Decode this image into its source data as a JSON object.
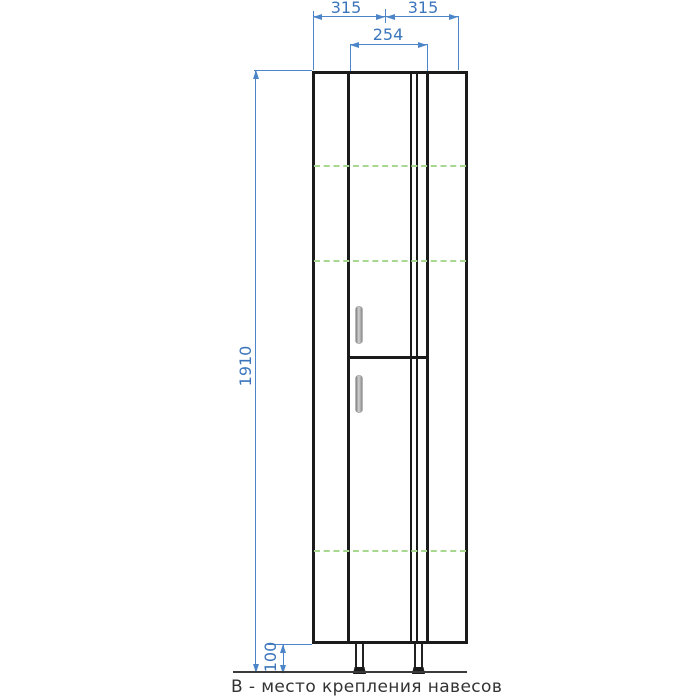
{
  "drawing": {
    "type": "furniture-elevation",
    "legend": {
      "text": "В - место крепления навесов"
    },
    "dimensions": {
      "top_left_width": "315",
      "top_right_width": "315",
      "door_width": "254",
      "cabinet_height": "1910",
      "leg_height": "100"
    },
    "colors": {
      "dimension_blue": "#4d86c8",
      "dimension_text_blue": "#3b76bd",
      "outline_black": "#1b1b1b",
      "mount_line_green": "#a8d88f",
      "handle_gray": "#b5b5b5",
      "floor_gray": "#3a3a3a",
      "background": "#ffffff"
    }
  }
}
